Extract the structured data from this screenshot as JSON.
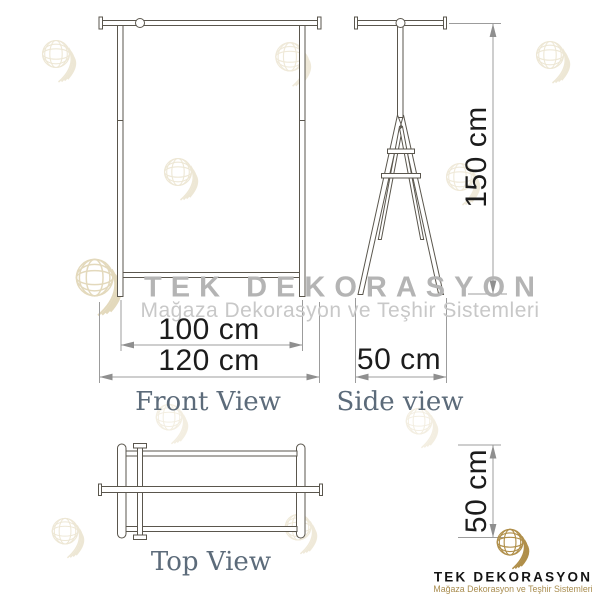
{
  "watermark": {
    "title": "TEK DEKORASYON",
    "subtitle": "Mağaza Dekorasyon ve Teşhir Sistemleri"
  },
  "brand": {
    "title": "TEK DEKORASYON",
    "subtitle": "Mağaza Dekorasyon ve Teşhir Sistemleri"
  },
  "views": {
    "front": {
      "label": "Front View",
      "dims": {
        "rail_width": "100 cm",
        "total_width": "120 cm"
      }
    },
    "side": {
      "label": "Side view",
      "dims": {
        "depth": "50 cm",
        "height": "150 cm"
      }
    },
    "top": {
      "label": "Top View",
      "dims": {
        "depth": "50 cm"
      }
    }
  },
  "colors": {
    "drawing_line": "#5a564d",
    "dimension_line": "#9c9c9c",
    "dimension_arrow": "#8f8f8f",
    "dimension_text": "#1c1c1c",
    "view_label": "#5c6b7a",
    "watermark_text": "#b4b4b4",
    "watermark_subtext": "#c8c8c8",
    "watermark_globe": "#ddd0ac",
    "brand_gold": "#b08f4a"
  }
}
